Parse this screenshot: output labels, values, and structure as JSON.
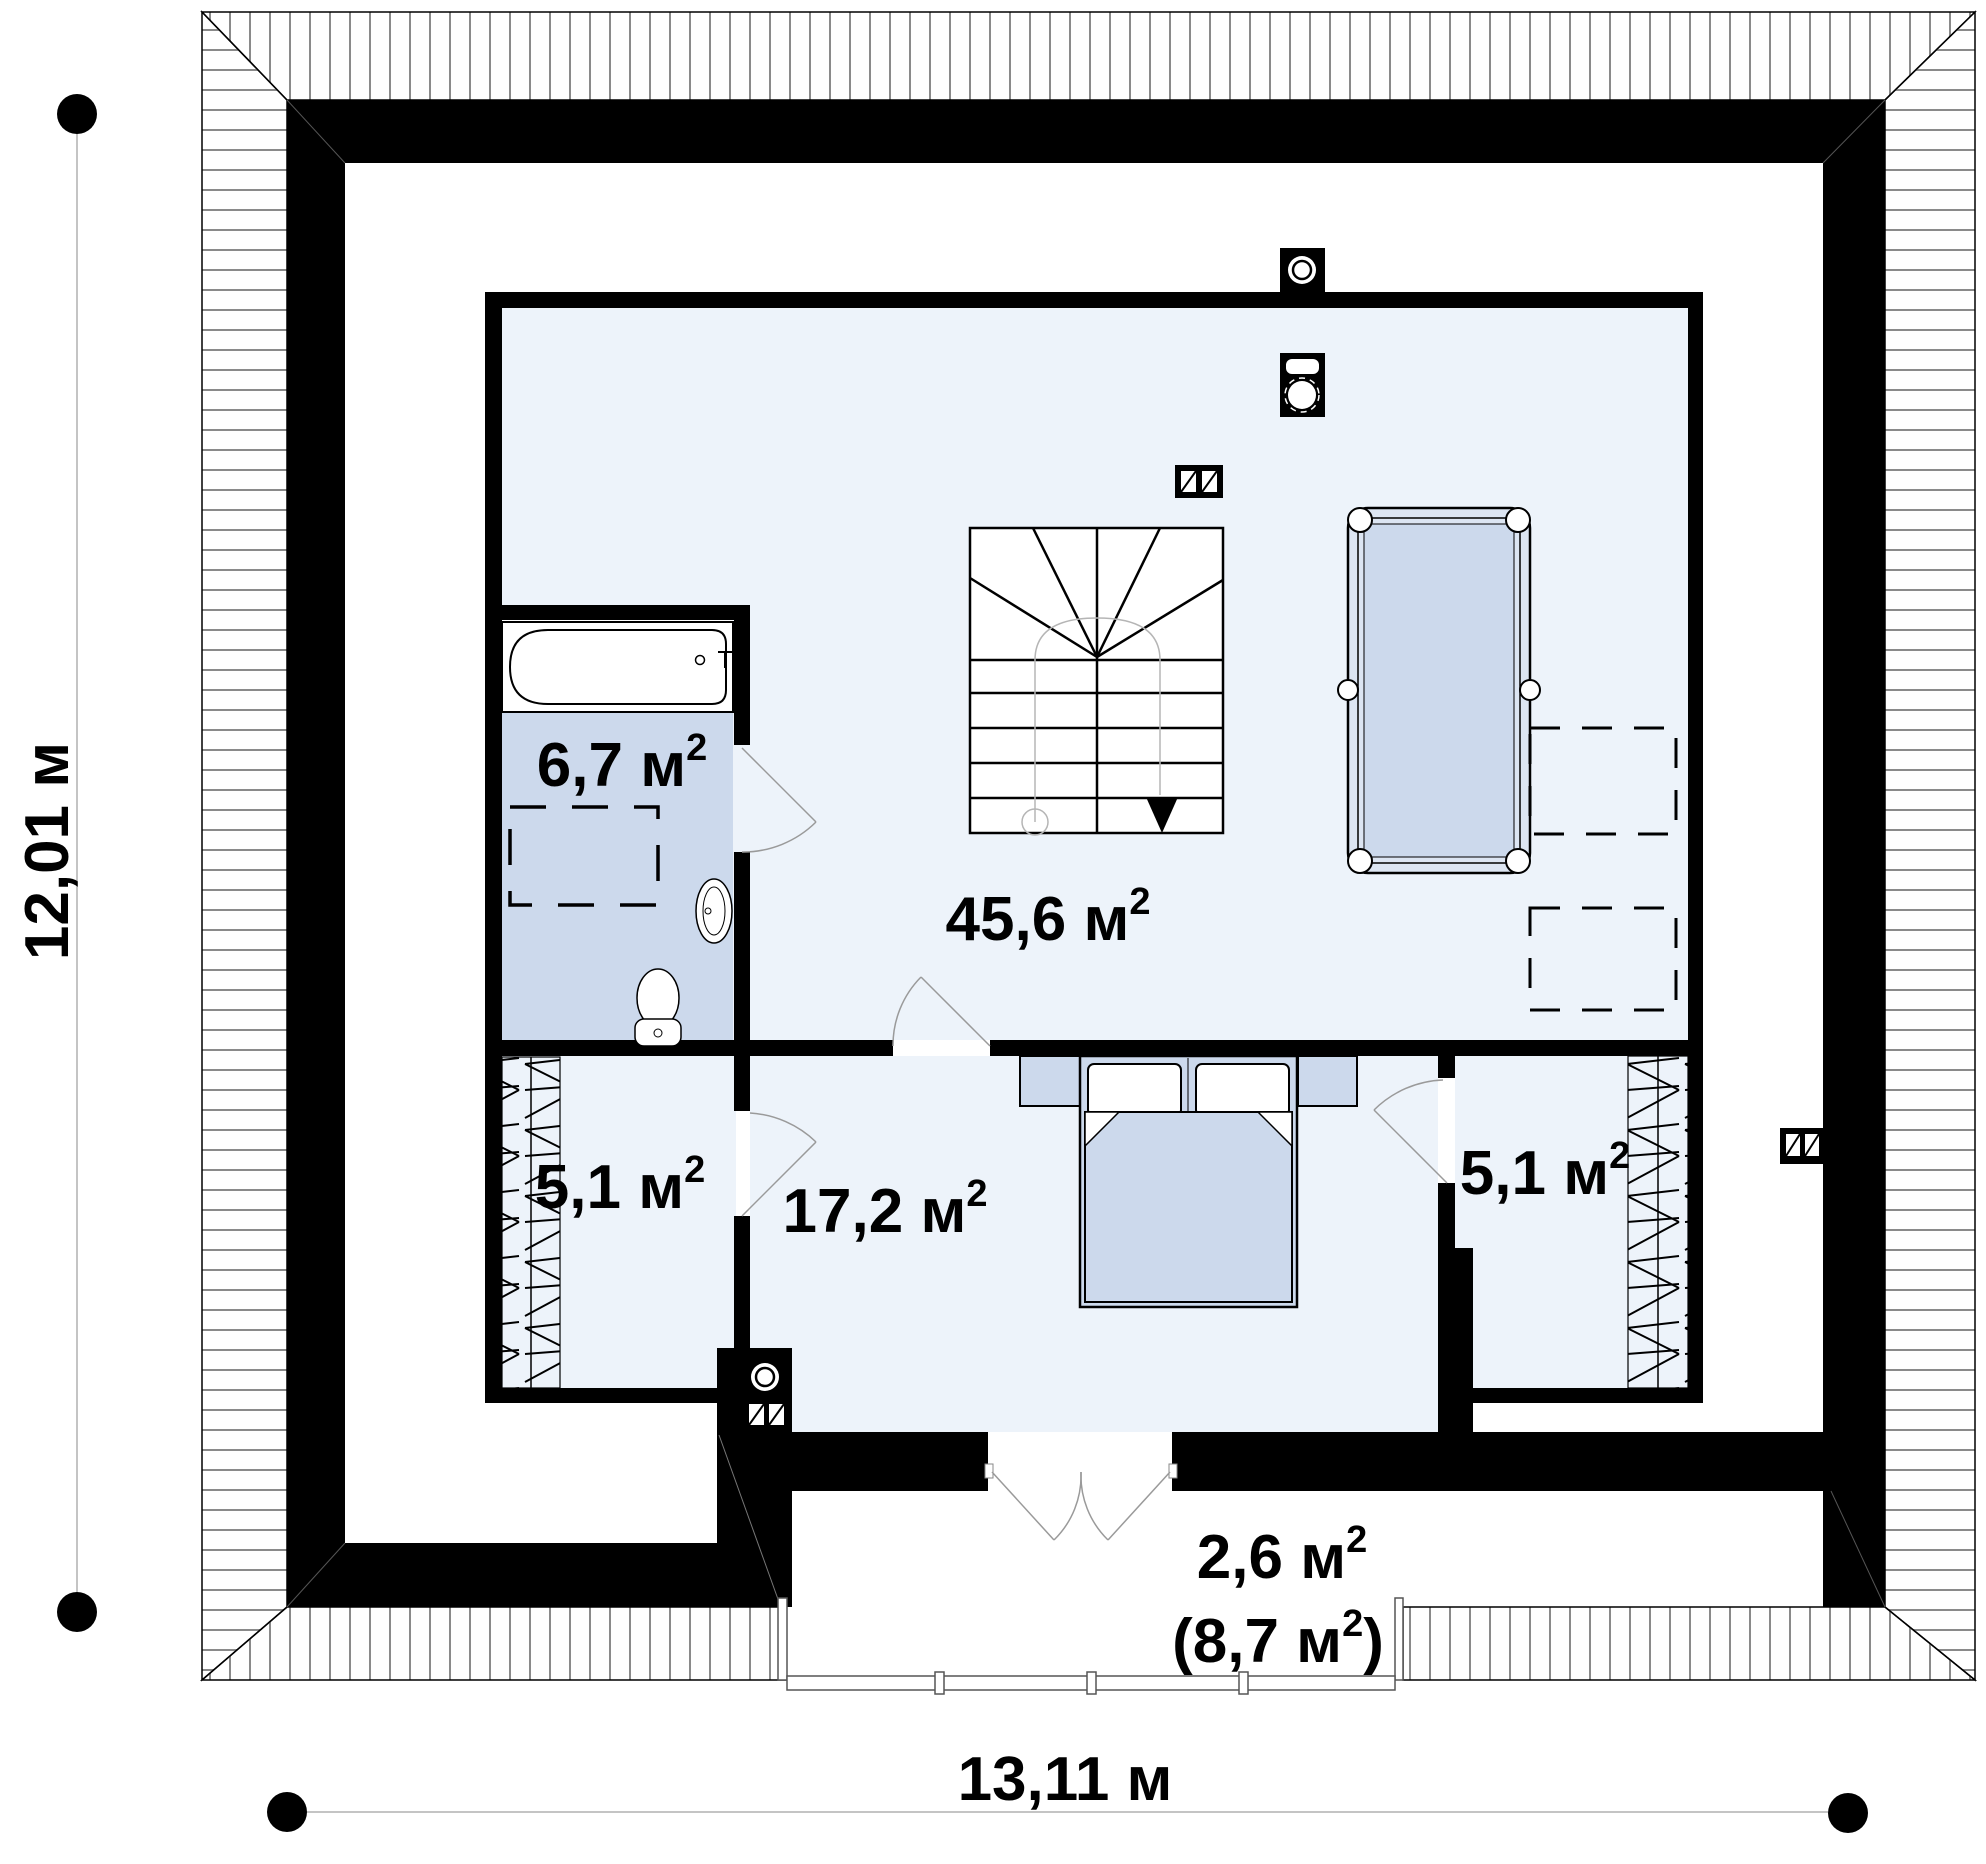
{
  "plan": {
    "type": "floor-plan",
    "dim_bottom": "13,11 м",
    "dim_left": "12,01 м",
    "rooms": {
      "bathroom": {
        "label": "6,7 м",
        "sup": "2"
      },
      "hall": {
        "label": "45,6 м",
        "sup": "2"
      },
      "closet_left": {
        "label": "5,1 м",
        "sup": "2"
      },
      "bedroom": {
        "label": "17,2 м",
        "sup": "2"
      },
      "closet_right": {
        "label": "5,1 м",
        "sup": "2"
      },
      "balcony": {
        "label": "2,6 м",
        "sup": "2",
        "alt_open": "(8,7 м",
        "alt_sup": "2",
        "alt_close": ")"
      }
    },
    "colors": {
      "wall": "#000000",
      "room_fill": "#edf3fa",
      "wet_fill": "#ccd9ec",
      "hatch_line": "#8a8a8a",
      "thin_line": "#9a9a9a"
    }
  }
}
